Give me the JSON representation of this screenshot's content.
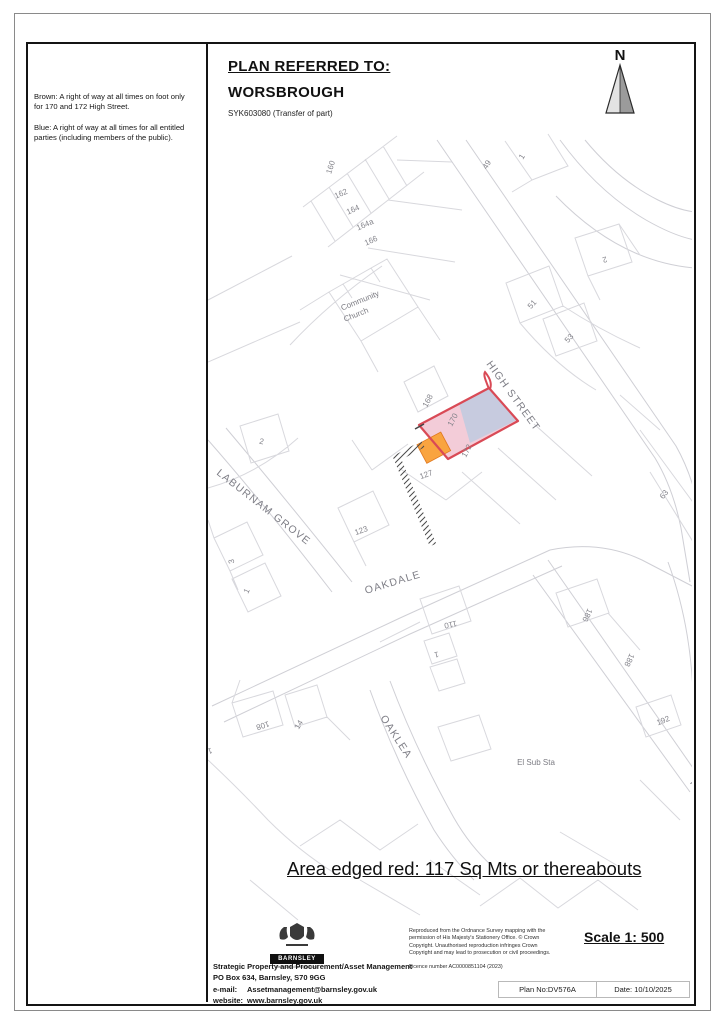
{
  "sidebar": {
    "brown_note": "Brown:  A right of way at all times on foot only for 170 and 172 High Street.",
    "blue_note": "Blue:  A right of way at all times for all entitled parties (including members of the public)."
  },
  "header": {
    "title": "PLAN REFERRED TO:",
    "town": "WORSBROUGH",
    "reference": "SYK603080 (Transfer of part)",
    "north_label": "N"
  },
  "map": {
    "area_note": "Area edged red: 117 Sq Mts or thereabouts",
    "colors": {
      "red_edge": "#d94a56",
      "pink_fill": "#f3ccd8",
      "blue_fill": "#c7cbdf",
      "orange_fill": "#f9a440"
    },
    "labels": [
      {
        "text": "160",
        "x": 333,
        "y": 168,
        "rot": -72,
        "cls": "num"
      },
      {
        "text": "162",
        "x": 342,
        "y": 196,
        "rot": -24,
        "cls": "num"
      },
      {
        "text": "164",
        "x": 354,
        "y": 212,
        "rot": -24,
        "cls": "num"
      },
      {
        "text": "164a",
        "x": 366,
        "y": 227,
        "rot": -24,
        "cls": "num"
      },
      {
        "text": "166",
        "x": 372,
        "y": 243,
        "rot": -24,
        "cls": "num"
      },
      {
        "text": "Community",
        "x": 361,
        "y": 303,
        "rot": -22,
        "cls": "place"
      },
      {
        "text": "Church",
        "x": 357,
        "y": 317,
        "rot": -22,
        "cls": "place"
      },
      {
        "text": "49",
        "x": 489,
        "y": 166,
        "rot": -58,
        "cls": "num"
      },
      {
        "text": "1",
        "x": 524,
        "y": 158,
        "rot": -58,
        "cls": "num"
      },
      {
        "text": "2",
        "x": 604,
        "y": 257,
        "rot": 162,
        "cls": "num"
      },
      {
        "text": "51",
        "x": 534,
        "y": 306,
        "rot": -48,
        "cls": "num"
      },
      {
        "text": "53",
        "x": 571,
        "y": 340,
        "rot": -48,
        "cls": "num"
      },
      {
        "text": "63",
        "x": 666,
        "y": 496,
        "rot": -52,
        "cls": "num"
      },
      {
        "text": "HIGH STREET",
        "x": 486,
        "y": 364,
        "rot": 54,
        "cls": "street",
        "anchor": "start"
      },
      {
        "text": "168",
        "x": 430,
        "y": 402,
        "rot": -62,
        "cls": "num"
      },
      {
        "text": "170",
        "x": 455,
        "y": 421,
        "rot": -62,
        "cls": "num"
      },
      {
        "text": "172",
        "x": 469,
        "y": 452,
        "rot": -62,
        "cls": "num"
      },
      {
        "text": "127",
        "x": 427,
        "y": 477,
        "rot": -20,
        "cls": "num"
      },
      {
        "text": "123",
        "x": 362,
        "y": 533,
        "rot": -20,
        "cls": "num"
      },
      {
        "text": "2",
        "x": 261,
        "y": 444,
        "rot": 12,
        "cls": "num"
      },
      {
        "text": "LABURNAM GROVE",
        "x": 216,
        "y": 474,
        "rot": 38,
        "cls": "street",
        "anchor": "start"
      },
      {
        "text": "3",
        "x": 234,
        "y": 561,
        "rot": -100,
        "cls": "num"
      },
      {
        "text": "1",
        "x": 249,
        "y": 592,
        "rot": -65,
        "cls": "num"
      },
      {
        "text": "OAKDALE",
        "x": 366,
        "y": 594,
        "rot": -17,
        "cls": "street",
        "anchor": "start"
      },
      {
        "text": "110",
        "x": 450,
        "y": 622,
        "rot": 168,
        "cls": "num"
      },
      {
        "text": "1",
        "x": 436,
        "y": 652,
        "rot": 168,
        "cls": "num"
      },
      {
        "text": "186",
        "x": 585,
        "y": 614,
        "rot": 115,
        "cls": "num"
      },
      {
        "text": "188",
        "x": 627,
        "y": 659,
        "rot": 115,
        "cls": "num"
      },
      {
        "text": "192",
        "x": 664,
        "y": 723,
        "rot": -22,
        "cls": "num"
      },
      {
        "text": "108",
        "x": 262,
        "y": 723,
        "rot": 162,
        "cls": "num"
      },
      {
        "text": "14",
        "x": 301,
        "y": 726,
        "rot": -58,
        "cls": "num"
      },
      {
        "text": "10",
        "x": 207,
        "y": 749,
        "rot": 162,
        "cls": "num"
      },
      {
        "text": "OAKLEA",
        "x": 380,
        "y": 718,
        "rot": 57,
        "cls": "street",
        "anchor": "start"
      },
      {
        "text": "El Sub Sta",
        "x": 536,
        "y": 765,
        "rot": 0,
        "cls": "place"
      },
      {
        "text": "P",
        "x": 692,
        "y": 786,
        "rot": 55,
        "cls": "street"
      }
    ]
  },
  "footer": {
    "logo_name": "BARNSLEY",
    "logo_caption": "Metropolitan Borough Council",
    "dept_line1": "Strategic Property and Procurement/Asset Management",
    "dept_line2": "PO Box 634, Barnsley, S70 9GG",
    "email_label": "e-mail:",
    "email_value": "Assetmanagement@barnsley.gov.uk",
    "website_label": "website:",
    "website_value": "www.barnsley.gov.uk",
    "copyright": "Reproduced from the Ordnance Survey mapping with the permission of His Majesty's Stationery Office. © Crown Copyright. Unauthorised reproduction infringes Crown Copyright and may lead to prosecution or civil proceedings.",
    "licence": "Licence number AC0000851104 (2023)",
    "scale": "Scale 1: 500",
    "plan_no": "Plan No:DV576A",
    "date": "Date: 10/10/2025"
  }
}
